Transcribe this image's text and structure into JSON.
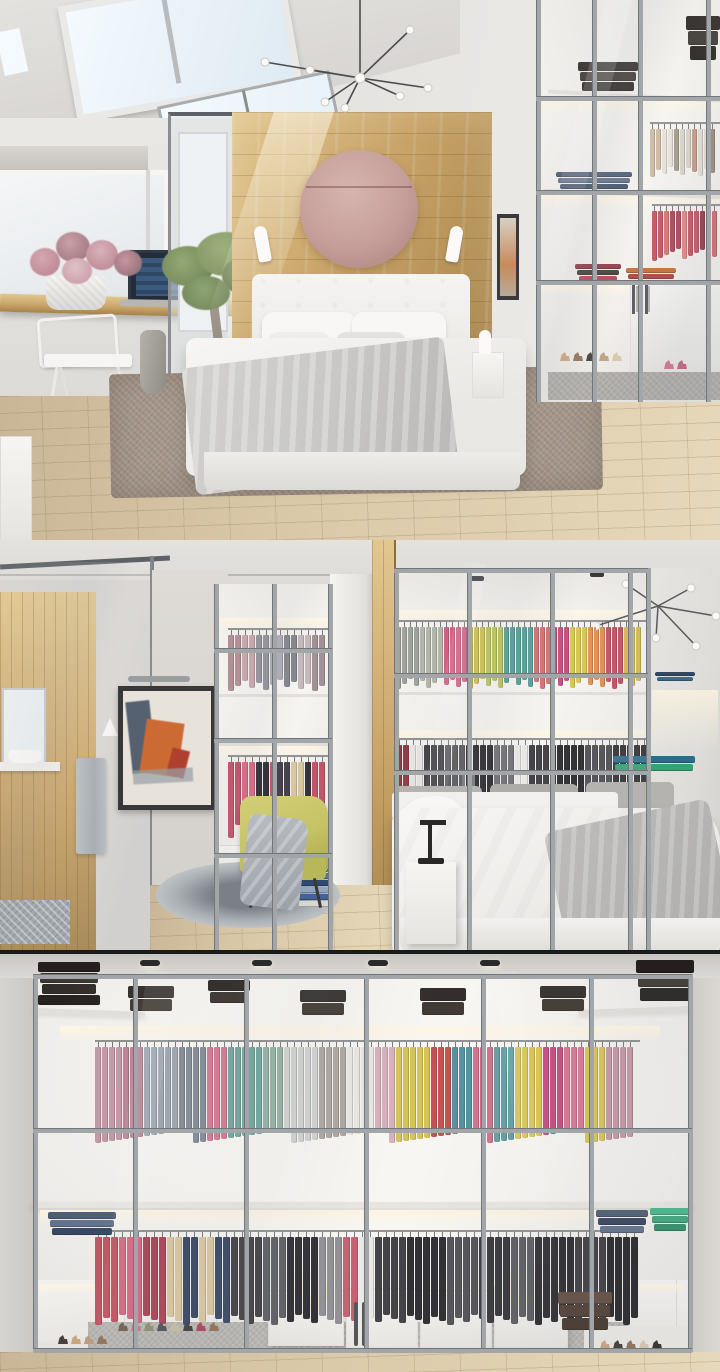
{
  "collage": {
    "panels": [
      {
        "name": "attic-bedroom-with-skylights"
      },
      {
        "name": "bedroom-behind-walk-in-closet"
      },
      {
        "name": "glass-wall-walk-in-closet"
      }
    ]
  },
  "palette": {
    "wall": "#eae8e5",
    "wallDim": "#dcdad6",
    "ceil": "#e4e2df",
    "ceilDark": "#cdcac6",
    "wood": "#c8a368",
    "woodDark": "#a5834a",
    "woodLight": "#e2c78f",
    "disc": "#c59e99",
    "discLight": "#d7b5ae",
    "discDark": "#a97f7c",
    "floor": "#d9c8a8",
    "floorDark": "#c9b696",
    "floorLight": "#e6d8ba",
    "furnWhite": "#f6f5f2",
    "furnWhiteDim": "#e6e4e0",
    "glowStrong": "#fff6e2",
    "mull": "#a3a6a9",
    "mullDark": "#72767a",
    "frameDark": "#5d6165",
    "rugBrown": "#a39588",
    "rugGray": "#b5b2ad",
    "bedWhite": "#f4f3f1",
    "linen": "#c9c8c6",
    "linenDark": "#aeadab",
    "skyGlass": "#dfeaf2",
    "skyBright": "#f4fafe",
    "canvasPaint": "#e7e2da",
    "paintOrange": "#cc6a33",
    "paintNavy": "#3c4a5e",
    "paintRed": "#b0402e",
    "chairYellow": "#c6c365",
    "chairYellowDark": "#abA84f",
    "towel": "#b7bcc0",
    "mirror": "#eef1f3",
    "seam": "#1a1a1a",
    "lampBlack": "#2a2826",
    "woodFloor2": "#dfcfae"
  },
  "scene": {
    "racks": [
      {
        "panel": 1,
        "name": "trousers-rail",
        "x": 650,
        "y": 122,
        "w": 70,
        "h": 56,
        "itemW": 5,
        "gap": 1,
        "rod": true,
        "var": 11,
        "colors": [
          {
            "c": "#cbb89a",
            "n": 2
          },
          {
            "c": "#e6e1d8",
            "n": 2
          },
          {
            "c": "#a09583",
            "n": 1
          },
          {
            "c": "#d8d2c6",
            "n": 2
          },
          {
            "c": "#c4937e",
            "n": 1
          },
          {
            "c": "#e0dbd2",
            "n": 2
          },
          {
            "c": "#8f8577",
            "n": 1
          }
        ]
      },
      {
        "panel": 1,
        "name": "coral-shirts-rail",
        "x": 652,
        "y": 204,
        "w": 68,
        "h": 58,
        "itemW": 5,
        "gap": 1,
        "rod": true,
        "var": 13,
        "colors": [
          {
            "c": "#c14a58",
            "n": 2
          },
          {
            "c": "#d96a6a",
            "n": 1
          },
          {
            "c": "#a83b4e",
            "n": 2
          },
          {
            "c": "#df8078",
            "n": 1
          },
          {
            "c": "#c14a58",
            "n": 2
          },
          {
            "c": "#8a2f3e",
            "n": 1
          },
          {
            "c": "#d25f66",
            "n": 2
          }
        ]
      },
      {
        "panel": 2,
        "name": "left-closet-top-rail",
        "x": 228,
        "y": 88,
        "w": 104,
        "h": 64,
        "itemW": 6,
        "gap": 1,
        "rod": true,
        "var": 12,
        "colors": [
          {
            "c": "#b08a90",
            "n": 2
          },
          {
            "c": "#c7a3a8",
            "n": 2
          },
          {
            "c": "#8d8d95",
            "n": 2
          },
          {
            "c": "#a8a8b0",
            "n": 2
          },
          {
            "c": "#7d7d85",
            "n": 2
          },
          {
            "c": "#c0b4b8",
            "n": 2
          },
          {
            "c": "#9a8a8e",
            "n": 2
          }
        ]
      },
      {
        "panel": 2,
        "name": "left-closet-bottom-rail",
        "x": 228,
        "y": 215,
        "w": 104,
        "h": 84,
        "itemW": 6,
        "gap": 1,
        "rod": true,
        "var": 16,
        "colors": [
          {
            "c": "#c2455f",
            "n": 2
          },
          {
            "c": "#d4607a",
            "n": 2
          },
          {
            "c": "#23212a",
            "n": 2
          },
          {
            "c": "#c2455f",
            "n": 1
          },
          {
            "c": "#3a3340",
            "n": 2
          },
          {
            "c": "#d8c49a",
            "n": 2
          },
          {
            "c": "#23212a",
            "n": 1
          },
          {
            "c": "#c2455f",
            "n": 2
          }
        ]
      },
      {
        "panel": 2,
        "name": "right-closet-top-rail",
        "x": 396,
        "y": 80,
        "w": 250,
        "h": 70,
        "itemW": 5,
        "gap": 1,
        "rod": true,
        "var": 12,
        "colors": [
          {
            "c": "#9aa096",
            "n": 4
          },
          {
            "c": "#b0b4a6",
            "n": 4
          },
          {
            "c": "#d0557a",
            "n": 4
          },
          {
            "c": "#cdbf4a",
            "n": 3
          },
          {
            "c": "#b9c253",
            "n": 3
          },
          {
            "c": "#4f9a94",
            "n": 5
          },
          {
            "c": "#d06a6a",
            "n": 3
          },
          {
            "c": "#c2457a",
            "n": 3
          },
          {
            "c": "#d8c24a",
            "n": 3
          },
          {
            "c": "#e08a4a",
            "n": 3
          },
          {
            "c": "#c24a5c",
            "n": 3
          },
          {
            "c": "#d8b84a",
            "n": 3
          }
        ]
      },
      {
        "panel": 2,
        "name": "right-closet-bottom-rail",
        "x": 396,
        "y": 198,
        "w": 252,
        "h": 88,
        "itemW": 6,
        "gap": 1,
        "rod": true,
        "var": 14,
        "colors": [
          {
            "c": "#8d2f3a",
            "n": 2
          },
          {
            "c": "#e8e5e1",
            "n": 2
          },
          {
            "c": "#37363a",
            "n": 3
          },
          {
            "c": "#55555a",
            "n": 3
          },
          {
            "c": "#232226",
            "n": 4
          },
          {
            "c": "#6b6a6e",
            "n": 3
          },
          {
            "c": "#e8e7e5",
            "n": 2
          },
          {
            "c": "#37363a",
            "n": 4
          },
          {
            "c": "#232226",
            "n": 4
          },
          {
            "c": "#4a494d",
            "n": 4
          },
          {
            "c": "#2e2d31",
            "n": 5
          }
        ]
      },
      {
        "panel": 3,
        "name": "upper-shirt-rail",
        "x": 95,
        "y": 90,
        "w": 545,
        "h": 104,
        "itemW": 6,
        "gap": 1,
        "rod": true,
        "var": 14,
        "colors": [
          {
            "c": "#c493a3",
            "n": 4
          },
          {
            "c": "#b87f93",
            "n": 3
          },
          {
            "c": "#9aa3ad",
            "n": 5
          },
          {
            "c": "#7f8791",
            "n": 4
          },
          {
            "c": "#d4728f",
            "n": 3
          },
          {
            "c": "#6aa39c",
            "n": 5
          },
          {
            "c": "#8fae9d",
            "n": 3
          },
          {
            "c": "#cfd0cd",
            "n": 5
          },
          {
            "c": "#a8a29a",
            "n": 4
          },
          {
            "c": "#e8e6e2",
            "n": 4
          },
          {
            "c": "#d8aab8",
            "n": 3
          },
          {
            "c": "#d2bf4e",
            "n": 5
          },
          {
            "c": "#c24545",
            "n": 3
          },
          {
            "c": "#4a8a9a",
            "n": 3
          },
          {
            "c": "#d06a88",
            "n": 3
          },
          {
            "c": "#5a9aa0",
            "n": 3
          },
          {
            "c": "#d8c24a",
            "n": 4
          },
          {
            "c": "#c2457a",
            "n": 3
          },
          {
            "c": "#d4728f",
            "n": 3
          },
          {
            "c": "#d8c24a",
            "n": 3
          },
          {
            "c": "#c493a3",
            "n": 4
          }
        ]
      },
      {
        "panel": 3,
        "name": "lower-garment-rail",
        "x": 95,
        "y": 280,
        "w": 545,
        "h": 96,
        "itemW": 7,
        "gap": 1,
        "rod": true,
        "var": 11,
        "colors": [
          {
            "c": "#c24a5c",
            "n": 3
          },
          {
            "c": "#d4607a",
            "n": 3
          },
          {
            "c": "#a83b50",
            "n": 3
          },
          {
            "c": "#d8c49a",
            "n": 2
          },
          {
            "c": "#2e3d5a",
            "n": 2
          },
          {
            "c": "#d8c49a",
            "n": 2
          },
          {
            "c": "#2e3d5a",
            "n": 2
          },
          {
            "c": "#37363a",
            "n": 4
          },
          {
            "c": "#55555a",
            "n": 3
          },
          {
            "c": "#232226",
            "n": 4
          },
          {
            "c": "#8a8a8e",
            "n": 3
          },
          {
            "c": "#c4556a",
            "n": 2
          },
          {
            "c": "#e8e7e5",
            "n": 2
          },
          {
            "c": "#37363a",
            "n": 4
          },
          {
            "c": "#232226",
            "n": 5
          },
          {
            "c": "#4a494e",
            "n": 4
          },
          {
            "c": "#2e2d31",
            "n": 4
          },
          {
            "c": "#55555a",
            "n": 3
          },
          {
            "c": "#232226",
            "n": 5
          },
          {
            "c": "#37363a",
            "n": 4
          },
          {
            "c": "#1f1e22",
            "n": 4
          }
        ]
      }
    ],
    "stacks": [
      {
        "panel": 1,
        "name": "box-stack",
        "x": 578,
        "y": 62,
        "w": 60,
        "h": 32,
        "colors": [
          "#2a2521",
          "#3a332c",
          "#241f1b"
        ]
      },
      {
        "panel": 1,
        "name": "box-stack",
        "x": 686,
        "y": 16,
        "w": 34,
        "h": 46,
        "colors": [
          "#241f1c",
          "#35302a",
          "#1d1916"
        ]
      },
      {
        "panel": 1,
        "name": "folded-jeans",
        "x": 556,
        "y": 172,
        "w": 76,
        "h": 20,
        "colors": [
          "#46566e",
          "#5b6b85",
          "#3a4a62"
        ]
      },
      {
        "panel": 1,
        "name": "folded-knits",
        "x": 575,
        "y": 264,
        "w": 46,
        "h": 20,
        "colors": [
          "#8a2f3e",
          "#3a332c",
          "#b03b4e"
        ]
      },
      {
        "panel": 1,
        "name": "folded-knits",
        "x": 626,
        "y": 268,
        "w": 50,
        "h": 20,
        "colors": [
          "#c2672f",
          "#a83b2e",
          "#d08a4a"
        ]
      },
      {
        "panel": 2,
        "name": "folded-navy",
        "x": 655,
        "y": 132,
        "w": 40,
        "h": 10,
        "colors": [
          "#2e4a6b",
          "#3a6b8a"
        ]
      },
      {
        "panel": 2,
        "name": "folded-teal",
        "x": 613,
        "y": 216,
        "w": 82,
        "h": 16,
        "colors": [
          "#2e6b8a",
          "#35a276"
        ]
      },
      {
        "panel": 2,
        "name": "book-pile",
        "layer": "front",
        "x": 292,
        "y": 312,
        "w": 40,
        "h": 56,
        "colors": [
          "#44629a",
          "#e8e6e2",
          "#35507f",
          "#5a7ab0",
          "#2e4a72",
          "#8fa5c4",
          "#44629a",
          "#d8d6d2"
        ]
      },
      {
        "panel": 3,
        "name": "box-stack",
        "x": 38,
        "y": 12,
        "w": 62,
        "h": 46,
        "colors": [
          "#241f1c",
          "#35302a",
          "#2a2521",
          "#1d1916"
        ]
      },
      {
        "panel": 3,
        "name": "box-stack",
        "x": 128,
        "y": 36,
        "w": 46,
        "h": 26,
        "colors": [
          "#2a2521",
          "#383028"
        ]
      },
      {
        "panel": 3,
        "name": "box-stack",
        "x": 208,
        "y": 30,
        "w": 42,
        "h": 24,
        "colors": [
          "#241f1c",
          "#332c26"
        ]
      },
      {
        "panel": 3,
        "name": "box-stack",
        "x": 300,
        "y": 40,
        "w": 46,
        "h": 26,
        "colors": [
          "#2a2521",
          "#383028"
        ]
      },
      {
        "panel": 3,
        "name": "box-stack",
        "x": 420,
        "y": 38,
        "w": 46,
        "h": 28,
        "colors": [
          "#241f1c",
          "#332c26"
        ]
      },
      {
        "panel": 3,
        "name": "box-stack",
        "x": 540,
        "y": 36,
        "w": 46,
        "h": 26,
        "colors": [
          "#2a2521",
          "#383028"
        ]
      },
      {
        "panel": 3,
        "name": "box-stack",
        "x": 636,
        "y": 10,
        "w": 58,
        "h": 44,
        "colors": [
          "#241f1c",
          "#35302a",
          "#1d1916"
        ]
      },
      {
        "panel": 3,
        "name": "folded-jeans",
        "x": 48,
        "y": 262,
        "w": 68,
        "h": 26,
        "colors": [
          "#46566e",
          "#5b6b85",
          "#2e3d5a"
        ]
      },
      {
        "panel": 3,
        "name": "folded-jeans",
        "x": 596,
        "y": 260,
        "w": 52,
        "h": 26,
        "colors": [
          "#46566e",
          "#2e3d5a",
          "#5b6b85"
        ]
      },
      {
        "panel": 3,
        "name": "folded-green",
        "x": 650,
        "y": 258,
        "w": 40,
        "h": 26,
        "colors": [
          "#3fb585",
          "#35a276",
          "#2a8a63"
        ]
      },
      {
        "panel": 3,
        "name": "leather-boxes",
        "x": 558,
        "y": 342,
        "w": 54,
        "h": 40,
        "colors": [
          "#5c463a",
          "#49372c",
          "#3e2e24"
        ]
      }
    ],
    "shoes": [
      {
        "panel": 1,
        "name": "heels-row",
        "x": 560,
        "y": 352,
        "colors": [
          "#c9a078",
          "#8a6b52",
          "#3a332c",
          "#b89a7a",
          "#d8c4a8"
        ]
      },
      {
        "panel": 1,
        "name": "pink-heels",
        "x": 664,
        "y": 360,
        "colors": [
          "#d06a88",
          "#c2557a"
        ]
      },
      {
        "panel": 3,
        "name": "heels-row",
        "x": 58,
        "y": 385,
        "colors": [
          "#3a332c",
          "#c9a078",
          "#b8987a",
          "#8a6b52"
        ]
      },
      {
        "panel": 3,
        "name": "flats-row",
        "x": 118,
        "y": 372,
        "colors": [
          "#6b5a4a",
          "#d06a88",
          "#8a8a6a",
          "#4a4a4e",
          "#c9b89a",
          "#37363a",
          "#a83b50",
          "#8a6b52"
        ]
      },
      {
        "panel": 3,
        "name": "heels-row",
        "x": 600,
        "y": 390,
        "colors": [
          "#c9a078",
          "#3a332c",
          "#8a6b52",
          "#d8c4a8",
          "#2a2521"
        ]
      }
    ],
    "mullions": [
      {
        "panel": 3,
        "vertical": [
          {
            "x": 33,
            "y": 24,
            "h": 378
          },
          {
            "x": 133,
            "y": 28,
            "h": 374
          },
          {
            "x": 244,
            "y": 28,
            "h": 374
          },
          {
            "x": 364,
            "y": 28,
            "h": 374
          },
          {
            "x": 481,
            "y": 28,
            "h": 374
          },
          {
            "x": 589,
            "y": 28,
            "h": 374
          },
          {
            "x": 688,
            "y": 24,
            "h": 378
          }
        ],
        "horizontal": [
          {
            "y": 24,
            "x": 33,
            "w": 659
          },
          {
            "y": 178,
            "x": 33,
            "w": 659
          },
          {
            "y": 398,
            "x": 33,
            "w": 659
          }
        ]
      },
      {
        "panel": 2,
        "vertical": [
          {
            "x": 394,
            "y": 28,
            "h": 384
          },
          {
            "x": 467,
            "y": 28,
            "h": 384
          },
          {
            "x": 550,
            "y": 28,
            "h": 384
          },
          {
            "x": 628,
            "y": 28,
            "h": 384
          },
          {
            "x": 646,
            "y": 28,
            "h": 384
          },
          {
            "x": 214,
            "y": 44,
            "h": 368
          },
          {
            "x": 272,
            "y": 44,
            "h": 368
          },
          {
            "x": 328,
            "y": 44,
            "h": 368
          }
        ],
        "horizontal": [
          {
            "y": 28,
            "x": 394,
            "w": 254
          },
          {
            "y": 133,
            "x": 394,
            "w": 254
          },
          {
            "y": 230,
            "x": 394,
            "w": 254
          },
          {
            "y": 108,
            "x": 214,
            "w": 118
          },
          {
            "y": 198,
            "x": 214,
            "w": 118
          },
          {
            "y": 313,
            "x": 214,
            "w": 118
          }
        ]
      },
      {
        "panel": 1,
        "vertical": [
          {
            "x": 536,
            "y": 0,
            "h": 402
          },
          {
            "x": 592,
            "y": 0,
            "h": 402
          },
          {
            "x": 638,
            "y": 0,
            "h": 402
          },
          {
            "x": 706,
            "y": 0,
            "h": 402
          }
        ],
        "horizontal": [
          {
            "y": 96,
            "x": 536,
            "w": 184
          },
          {
            "y": 190,
            "x": 536,
            "w": 184
          },
          {
            "y": 280,
            "x": 536,
            "w": 184
          }
        ]
      }
    ]
  }
}
